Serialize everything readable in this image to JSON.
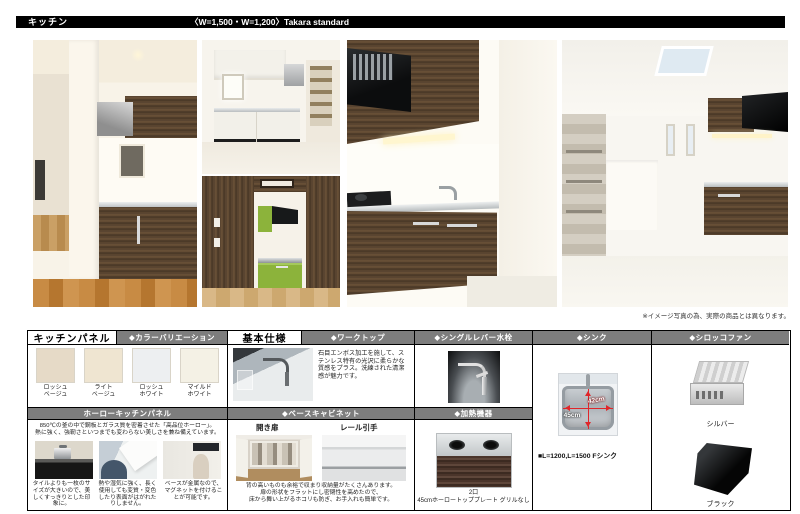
{
  "header": {
    "title": "キッチン",
    "subtitle": "〈W=1,500・W=1,200〉Takara standard"
  },
  "note": "※イメージ写真の為、実際の商品とは異なります。",
  "colors": {
    "section_bar_gray": "#7d7d7d",
    "dimension_red": "#e0262a",
    "header_black": "#000000"
  },
  "kitchen_panel": {
    "title": "キッチンパネル",
    "color_variation_header": "◆カラーバリエーション",
    "swatches": [
      {
        "line1": "ロッシュ",
        "line2": "ベージュ",
        "hex": "#e6dac7"
      },
      {
        "line1": "ライト",
        "line2": "ベージュ",
        "hex": "#efe5d1"
      },
      {
        "line1": "ロッシュ",
        "line2": "ホワイト",
        "hex": "#edeff1"
      },
      {
        "line1": "マイルド",
        "line2": "ホワイト",
        "hex": "#f4f1e5"
      }
    ],
    "horo_header": "ホーローキッチンパネル",
    "horo_desc1": "850℃の釜の中で鋼板とガラス質を密着させた「高品位ホーロー」。",
    "horo_desc2": "熱に強く、強靭さといつまでも変わらない美しさを兼ね備えています。",
    "feature_captions": [
      "タイルよりも一枚のサイズが大きいので、美しくすっきりとした印象に。",
      "熱や湿気に強く、長く使用しても変質・変色したり表面がはがれたりしません。",
      "ベースが金属なので、マグネットを付けることが可能です。"
    ]
  },
  "basic_spec": {
    "title": "基本仕様",
    "worktop_header": "◆ワークトップ",
    "worktop_desc": "石目エンボス加工を施して、ステンレス特有の光沢に柔らかな質感をプラス。洗練された清潔感が魅力です。",
    "base_cabinet_header": "◆ベースキャビネット",
    "door_label": "開き扉",
    "handle_label": "レール引手",
    "bc_desc1": "背の高いものも余裕で収まり収納量がたくさんあります。",
    "bc_desc2": "扉の形状をフラットにし密閉性を高めたので、",
    "bc_desc3": "床から舞い上がるホコリも防ぎ、お手入れも簡単です。"
  },
  "faucet": {
    "header": "◆シングルレバー水栓"
  },
  "heater": {
    "header": "◆加熱機器",
    "caption_line1": "2口",
    "caption_line2": "45cmホーロートッププレート グリルなし"
  },
  "sink": {
    "header": "◆シンク",
    "width_label": "42cm",
    "depth_label": "45cm",
    "model_label": "■L=1200,L=1500 Fシンク"
  },
  "fan": {
    "header": "◆シロッコファン",
    "silver_label": "シルバー",
    "black_label": "ブラック"
  }
}
